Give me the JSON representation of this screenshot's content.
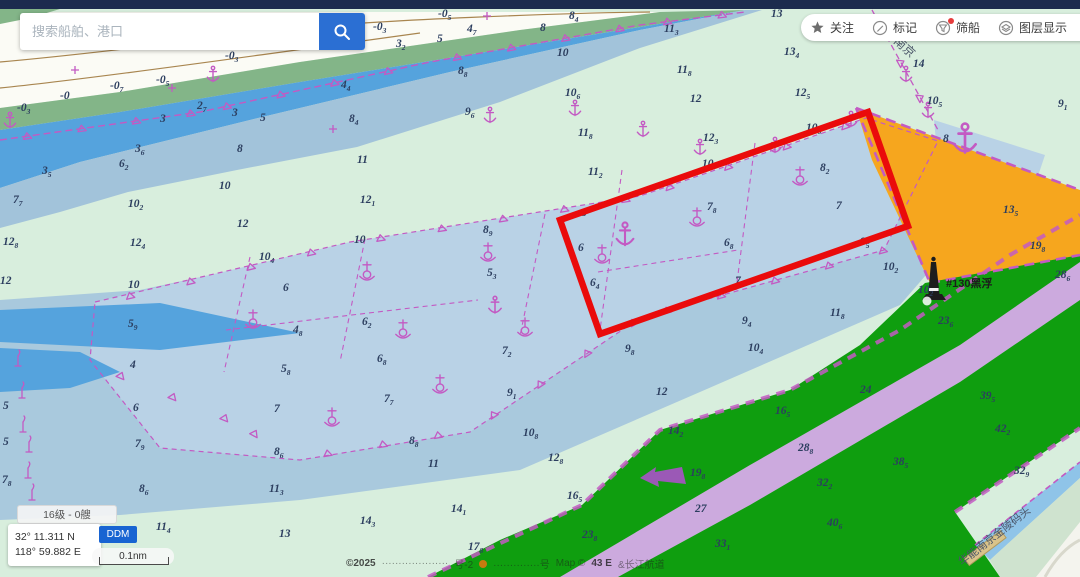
{
  "search": {
    "placeholder": "搜索船舶、港口"
  },
  "toolbar": {
    "items": [
      {
        "label": "关注",
        "icon": "star-icon"
      },
      {
        "label": "标记",
        "icon": "pencil-icon"
      },
      {
        "label": "筛船",
        "icon": "funnel-icon",
        "badge": true
      },
      {
        "label": "图层显示",
        "icon": "layers-icon"
      },
      {
        "label": "",
        "icon": "ship-icon"
      }
    ]
  },
  "status": {
    "zoom_badge": "16级 - 0艘",
    "lat": "32° 11.311 N",
    "lon": "118° 59.882 E",
    "format_button": "DDM",
    "scale_label": "0.1nm"
  },
  "attribution": {
    "segments": [
      {
        "t": "©2025",
        "s": "strong"
      },
      {
        "t": "····················",
        "s": ""
      },
      {
        "t": "号-2",
        "s": ""
      },
      {
        "t": "•",
        "s": "dot"
      },
      {
        "t": "··············号",
        "s": ""
      },
      {
        "t": "Map ©",
        "s": ""
      },
      {
        "t": "43 E",
        "s": "strong"
      },
      {
        "t": "&长江航道",
        "s": ""
      }
    ]
  },
  "map": {
    "colors": {
      "mint": "#d8eedd",
      "flats": "#fbfbf5",
      "marsh": "#83b588",
      "blue_bright": "#55a3dd",
      "blue_gray": "#a2c3da",
      "water_blob": "#a9c9dd",
      "anchorage": "#b9d2e6",
      "green": "#0f9e0f",
      "lavender": "#ccaade",
      "orange": "#f6a61e",
      "navy_bar": "#1c2b4e",
      "magenta": "#c35ac3",
      "highlight_red": "#ea0b0b",
      "sounding_text": "#2c3e5f",
      "contour_tan": "#a8854f"
    },
    "labels": {
      "buoy": "#130黑浮",
      "nanjing": "南京",
      "wharf": "华能南京金陵码头"
    },
    "soundings": [
      [
        60,
        99,
        "-0",
        ""
      ],
      [
        110,
        89,
        "-0",
        "7"
      ],
      [
        156,
        83,
        "-0",
        "5"
      ],
      [
        225,
        59,
        "-0",
        "3"
      ],
      [
        373,
        30,
        "-0",
        "3"
      ],
      [
        438,
        17,
        "-0",
        "5"
      ],
      [
        17,
        111,
        "-0",
        "3"
      ],
      [
        160,
        122,
        "3",
        ""
      ],
      [
        197,
        109,
        "2",
        "7"
      ],
      [
        232,
        116,
        "3",
        ""
      ],
      [
        260,
        121,
        "5",
        ""
      ],
      [
        341,
        88,
        "4",
        "4"
      ],
      [
        349,
        122,
        "8",
        "4"
      ],
      [
        135,
        152,
        "3",
        "6"
      ],
      [
        119,
        167,
        "6",
        "2"
      ],
      [
        42,
        174,
        "3",
        "5"
      ],
      [
        13,
        203,
        "7",
        "7"
      ],
      [
        128,
        207,
        "10",
        "2"
      ],
      [
        237,
        152,
        "8",
        ""
      ],
      [
        219,
        189,
        "10",
        ""
      ],
      [
        237,
        227,
        "12",
        ""
      ],
      [
        130,
        246,
        "12",
        "4"
      ],
      [
        3,
        245,
        "12",
        "8"
      ],
      [
        396,
        47,
        "3",
        "2"
      ],
      [
        437,
        42,
        "5",
        ""
      ],
      [
        467,
        32,
        "4",
        "7"
      ],
      [
        540,
        31,
        "8",
        ""
      ],
      [
        569,
        19,
        "8",
        "4"
      ],
      [
        458,
        74,
        "8",
        "8"
      ],
      [
        465,
        115,
        "9",
        "6"
      ],
      [
        357,
        163,
        "11",
        ""
      ],
      [
        360,
        203,
        "12",
        "1"
      ],
      [
        557,
        56,
        "10",
        ""
      ],
      [
        565,
        96,
        "10",
        "6"
      ],
      [
        664,
        32,
        "11",
        "3"
      ],
      [
        677,
        73,
        "11",
        "8"
      ],
      [
        690,
        102,
        "12",
        ""
      ],
      [
        703,
        141,
        "12",
        "3"
      ],
      [
        771,
        17,
        "13",
        ""
      ],
      [
        784,
        55,
        "13",
        "4"
      ],
      [
        795,
        96,
        "12",
        "5"
      ],
      [
        806,
        131,
        "10",
        "8"
      ],
      [
        578,
        136,
        "11",
        "8"
      ],
      [
        588,
        175,
        "11",
        "2"
      ],
      [
        913,
        67,
        "14",
        ""
      ],
      [
        927,
        104,
        "10",
        "5"
      ],
      [
        943,
        142,
        "8",
        ""
      ],
      [
        1058,
        107,
        "9",
        "1"
      ],
      [
        1003,
        213,
        "13",
        "5"
      ],
      [
        1030,
        249,
        "19",
        "8"
      ],
      [
        1055,
        278,
        "28",
        "6"
      ],
      [
        938,
        324,
        "23",
        "6"
      ],
      [
        918,
        293,
        "10",
        "2"
      ],
      [
        0,
        284,
        "12",
        ""
      ],
      [
        128,
        288,
        "10",
        ""
      ],
      [
        128,
        327,
        "5",
        "9"
      ],
      [
        130,
        368,
        "4",
        ""
      ],
      [
        3,
        409,
        "5",
        ""
      ],
      [
        3,
        445,
        "5",
        ""
      ],
      [
        2,
        483,
        "7",
        "8"
      ],
      [
        133,
        411,
        "6",
        ""
      ],
      [
        135,
        447,
        "7",
        "9"
      ],
      [
        139,
        492,
        "8",
        "6"
      ],
      [
        274,
        412,
        "7",
        ""
      ],
      [
        274,
        455,
        "8",
        "6"
      ],
      [
        269,
        492,
        "11",
        "3"
      ],
      [
        156,
        530,
        "11",
        "4"
      ],
      [
        25,
        562,
        "11",
        "4"
      ],
      [
        279,
        537,
        "13",
        ""
      ],
      [
        507,
        396,
        "9",
        "1"
      ],
      [
        656,
        395,
        "12",
        ""
      ],
      [
        523,
        436,
        "10",
        "8"
      ],
      [
        548,
        461,
        "12",
        "8"
      ],
      [
        451,
        512,
        "14",
        "1"
      ],
      [
        428,
        467,
        "11",
        ""
      ],
      [
        625,
        352,
        "9",
        "8"
      ],
      [
        742,
        324,
        "9",
        "4"
      ],
      [
        748,
        351,
        "10",
        "4"
      ],
      [
        830,
        316,
        "11",
        "8"
      ],
      [
        860,
        245,
        "9",
        "5"
      ],
      [
        883,
        270,
        "10",
        "2"
      ],
      [
        409,
        444,
        "8",
        "8"
      ],
      [
        360,
        524,
        "14",
        "3"
      ],
      [
        259,
        260,
        "10",
        "4"
      ],
      [
        354,
        243,
        "10",
        ""
      ],
      [
        283,
        291,
        "6",
        ""
      ],
      [
        293,
        333,
        "4",
        "8"
      ],
      [
        281,
        372,
        "5",
        "8"
      ],
      [
        362,
        325,
        "6",
        "2"
      ],
      [
        377,
        362,
        "6",
        "8"
      ],
      [
        384,
        402,
        "7",
        "7"
      ],
      [
        483,
        233,
        "8",
        "9"
      ],
      [
        487,
        276,
        "5",
        "3"
      ],
      [
        502,
        354,
        "7",
        "2"
      ],
      [
        581,
        216,
        "8",
        ""
      ],
      [
        578,
        251,
        "6",
        ""
      ],
      [
        590,
        286,
        "6",
        "4"
      ],
      [
        707,
        210,
        "7",
        "8"
      ],
      [
        724,
        246,
        "6",
        "8"
      ],
      [
        735,
        284,
        "7",
        "7"
      ],
      [
        820,
        171,
        "8",
        "2"
      ],
      [
        836,
        209,
        "7",
        ""
      ],
      [
        702,
        167,
        "10",
        ""
      ],
      [
        668,
        434,
        "14",
        "2"
      ],
      [
        775,
        414,
        "16",
        "5"
      ],
      [
        690,
        476,
        "19",
        "8"
      ],
      [
        567,
        499,
        "16",
        "5"
      ],
      [
        582,
        538,
        "23",
        "8"
      ],
      [
        695,
        512,
        "27",
        ""
      ],
      [
        715,
        547,
        "33",
        "1"
      ],
      [
        798,
        451,
        "28",
        "8"
      ],
      [
        860,
        393,
        "24",
        ""
      ],
      [
        817,
        486,
        "32",
        "2"
      ],
      [
        827,
        526,
        "40",
        "6"
      ],
      [
        468,
        550,
        "17",
        "8"
      ],
      [
        893,
        465,
        "38",
        "5"
      ],
      [
        980,
        399,
        "39",
        "5"
      ],
      [
        995,
        432,
        "42",
        "2"
      ],
      [
        1014,
        474,
        "32",
        "9"
      ]
    ],
    "symbols": {
      "anchors": [
        [
          10,
          122,
          1
        ],
        [
          213,
          76,
          1
        ],
        [
          490,
          117,
          1
        ],
        [
          575,
          110,
          1
        ],
        [
          643,
          131,
          1
        ],
        [
          700,
          149,
          1
        ],
        [
          775,
          147,
          1
        ],
        [
          851,
          121,
          1
        ],
        [
          625,
          237,
          1.5
        ],
        [
          495,
          307,
          1.1
        ],
        [
          965,
          142,
          1.9
        ],
        [
          884,
          32,
          1
        ],
        [
          906,
          76,
          1
        ],
        [
          928,
          112,
          1
        ]
      ],
      "moorings": [
        [
          253,
          320
        ],
        [
          367,
          272
        ],
        [
          403,
          330
        ],
        [
          440,
          385
        ],
        [
          332,
          418
        ],
        [
          488,
          253
        ],
        [
          525,
          328
        ],
        [
          602,
          255
        ],
        [
          697,
          218
        ],
        [
          800,
          177
        ]
      ],
      "beacons": [
        [
          18,
          360
        ],
        [
          22,
          392
        ],
        [
          23,
          426
        ],
        [
          29,
          446
        ],
        [
          28,
          472
        ],
        [
          32,
          494
        ]
      ],
      "crosses": [
        [
          75,
          70
        ],
        [
          172,
          88
        ],
        [
          333,
          129
        ],
        [
          487,
          16
        ]
      ]
    },
    "hachure_lines": [
      {
        "pts": [
          [
            0,
            140
          ],
          [
            200,
            112
          ],
          [
            430,
            62
          ],
          [
            640,
            25
          ],
          [
            745,
            12
          ]
        ],
        "step": 55
      },
      {
        "pts": [
          [
            100,
            303
          ],
          [
            350,
            243
          ],
          [
            640,
            197
          ],
          [
            862,
            120
          ]
        ],
        "step": 62
      },
      {
        "pts": [
          [
            95,
            365
          ],
          [
            230,
            420
          ],
          [
            300,
            458
          ],
          [
            470,
            430
          ],
          [
            640,
            318
          ],
          [
            884,
            250
          ]
        ],
        "step": 56
      },
      {
        "pts": [
          [
            872,
            10
          ],
          [
            938,
            130
          ]
        ],
        "step": 40
      }
    ]
  }
}
